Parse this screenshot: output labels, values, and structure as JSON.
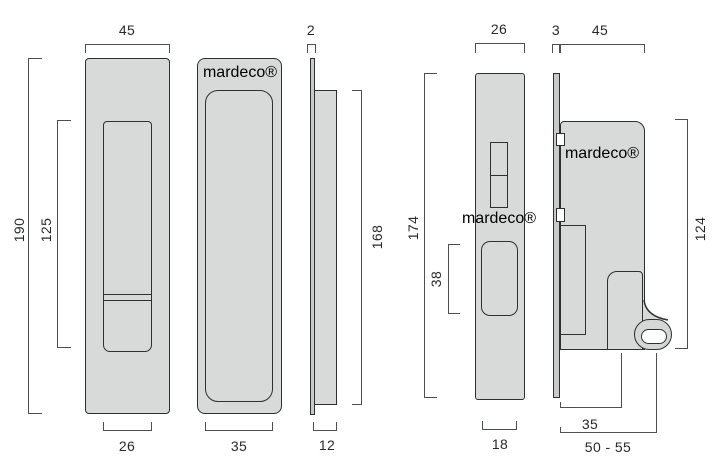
{
  "brand": {
    "mar": "mar",
    "deco": "deco",
    "reg": "®"
  },
  "dims": {
    "pull_width": "45",
    "pull_height": "190",
    "pull_recess_height": "125",
    "pull_recess_width": "26",
    "pull2_recess_width": "35",
    "edge_thickness": "2",
    "cup_height": "168",
    "cup_depth": "12",
    "faceplate_width": "26",
    "faceplate_height": "174",
    "bolt_window_height": "38",
    "case_thickness": "18",
    "backplate_thickness": "3",
    "case_width": "45",
    "case_height": "124",
    "snib_offset": "35",
    "backset": "50 - 55"
  }
}
